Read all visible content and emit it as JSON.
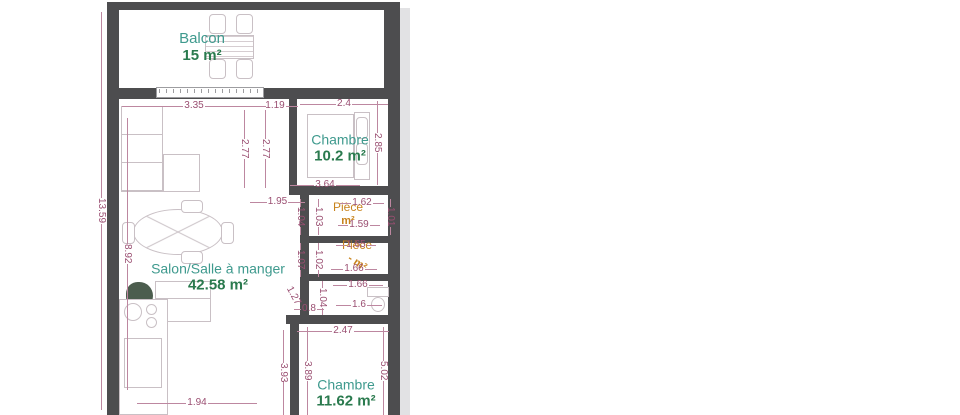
{
  "plan": {
    "title": "apartment-floor-plan",
    "rooms": {
      "balcon": {
        "name": "Balcon",
        "area": "15 m²"
      },
      "chambre1": {
        "name": "Chambre",
        "area": "10.2 m²"
      },
      "salon": {
        "name": "Salon/Salle à manger",
        "area": "42.58 m²"
      },
      "piece1": {
        "name": "Pièce",
        "area": "m²"
      },
      "piece2": {
        "name": "Pièce",
        "area": "- m²"
      },
      "chambre2": {
        "name": "Chambre",
        "area": "11.62 m²"
      }
    },
    "dimensions": [
      {
        "t": "3.35",
        "o": "h",
        "x": 122,
        "y": 100,
        "l": 144
      },
      {
        "t": "1.19",
        "o": "h",
        "x": 252,
        "y": 100,
        "l": 46
      },
      {
        "t": "2.4",
        "o": "h",
        "x": 300,
        "y": 98,
        "l": 88
      },
      {
        "t": "2.77",
        "o": "v",
        "x": 238,
        "y": 110,
        "l": 78
      },
      {
        "t": "2.77",
        "o": "v",
        "x": 259,
        "y": 110,
        "l": 78
      },
      {
        "t": "2.85",
        "o": "v",
        "x": 371,
        "y": 101,
        "l": 84
      },
      {
        "t": "3.64",
        "o": "h",
        "x": 290,
        "y": 179,
        "l": 70
      },
      {
        "t": "1.95",
        "o": "h",
        "x": 250,
        "y": 196,
        "l": 55
      },
      {
        "t": "13.59",
        "o": "v",
        "x": 95,
        "y": 12,
        "l": 398
      },
      {
        "t": "8.92",
        "o": "v",
        "x": 121,
        "y": 118,
        "l": 272
      },
      {
        "t": "1.62",
        "o": "h",
        "x": 340,
        "y": 197,
        "l": 44
      },
      {
        "t": "1.59",
        "o": "h",
        "x": 338,
        "y": 219,
        "l": 42
      },
      {
        "t": "1.04",
        "o": "v",
        "x": 294,
        "y": 199,
        "l": 36
      },
      {
        "t": "1.03",
        "o": "v",
        "x": 312,
        "y": 199,
        "l": 36
      },
      {
        "t": "1.01",
        "o": "v",
        "x": 384,
        "y": 199,
        "l": 36
      },
      {
        "t": "1.65",
        "o": "h",
        "x": 336,
        "y": 239,
        "l": 40
      },
      {
        "t": "1.66",
        "o": "h",
        "x": 331,
        "y": 263,
        "l": 46
      },
      {
        "t": "1.07",
        "o": "v",
        "x": 294,
        "y": 243,
        "l": 34
      },
      {
        "t": "1.02",
        "o": "v",
        "x": 312,
        "y": 243,
        "l": 34
      },
      {
        "t": "1.66",
        "o": "h",
        "x": 333,
        "y": 279,
        "l": 50
      },
      {
        "t": "1.6",
        "o": "h",
        "x": 336,
        "y": 299,
        "l": 46
      },
      {
        "t": "1.04",
        "o": "v",
        "x": 316,
        "y": 281,
        "l": 34
      },
      {
        "t": "1.27",
        "o": "d",
        "x": 278,
        "y": 290,
        "l": 30,
        "rot": 62
      },
      {
        "t": "0.8",
        "o": "h",
        "x": 294,
        "y": 303,
        "l": 30
      },
      {
        "t": "2.47",
        "o": "h",
        "x": 297,
        "y": 325,
        "l": 92
      },
      {
        "t": "5.02",
        "o": "v",
        "x": 377,
        "y": 327,
        "l": 88
      },
      {
        "t": "3.93",
        "o": "v",
        "x": 277,
        "y": 330,
        "l": 85
      },
      {
        "t": "3.89",
        "o": "v",
        "x": 301,
        "y": 327,
        "l": 88
      },
      {
        "t": "1.94",
        "o": "h",
        "x": 137,
        "y": 397,
        "l": 120
      }
    ],
    "colors": {
      "wall": "#4d4d4f",
      "dimension_text": "#9a4e71",
      "room_name": "#3f9a8e",
      "room_area": "#2a7a4e",
      "piece_label": "#c8831c",
      "furniture_line": "#c9c0c5",
      "shadow": "#e2e2e4"
    }
  }
}
